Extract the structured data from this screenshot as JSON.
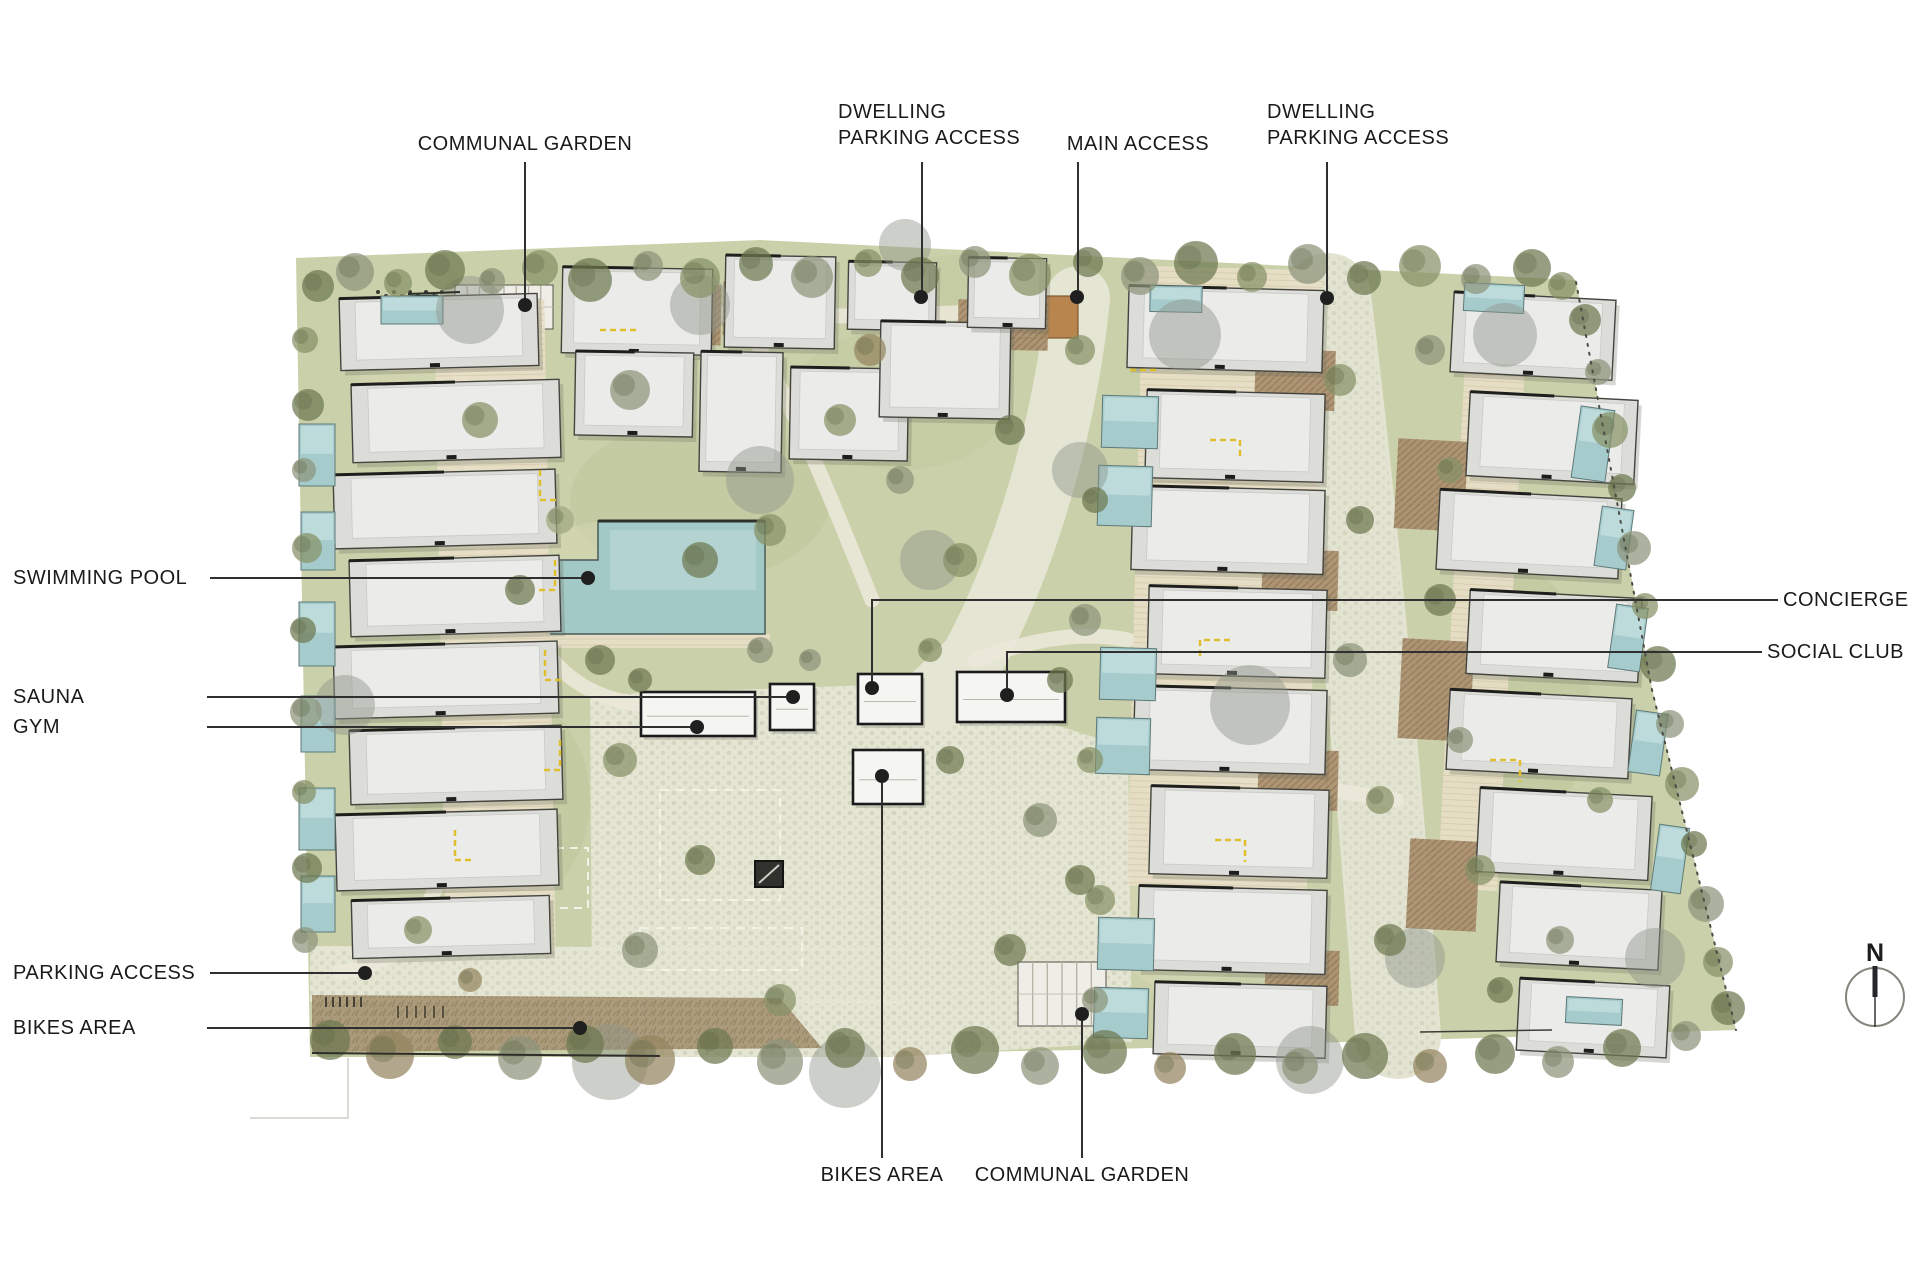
{
  "labels": {
    "communal_garden_top": "COMMUNAL GARDEN",
    "dwelling_parking_left": {
      "line1": "DWELLING",
      "line2": "PARKING ACCESS"
    },
    "main_access": "MAIN ACCESS",
    "dwelling_parking_right": {
      "line1": "DWELLING",
      "line2": "PARKING ACCESS"
    },
    "swimming_pool": "SWIMMING POOL",
    "sauna": "SAUNA",
    "gym": "GYM",
    "concierge": "CONCIERGE",
    "social_club": "SOCIAL CLUB",
    "parking_access": "PARKING ACCESS",
    "bikes_area_left": "BIKES AREA",
    "bikes_area_bottom": "BIKES AREA",
    "communal_garden_bottom": "COMMUNAL GARDEN"
  },
  "north_arrow": {
    "label": "N"
  },
  "colors": {
    "site_green": "#cad0a9",
    "plaza_cobble": "#e4e5d3",
    "path": "#ece9da",
    "pool_blue": "#a3c9c6",
    "small_pool_blue": "#a6cbcd",
    "building_gray": "#dcddd8",
    "building_outline": "#44443f",
    "amenity_white": "#f5f5f1",
    "deck_beige": "#e8dfc8",
    "pergola_brown": "#a98e6c",
    "bikes_strip_brown": "#a89776",
    "accent_yellow": "#e0bf2e",
    "tree_dark_olive": "#6e7951",
    "tree_sage": "#9fa981",
    "gate_orange": "#b8854e",
    "label_text": "#1a1a1a",
    "leader_line": "#2f2f2f"
  }
}
